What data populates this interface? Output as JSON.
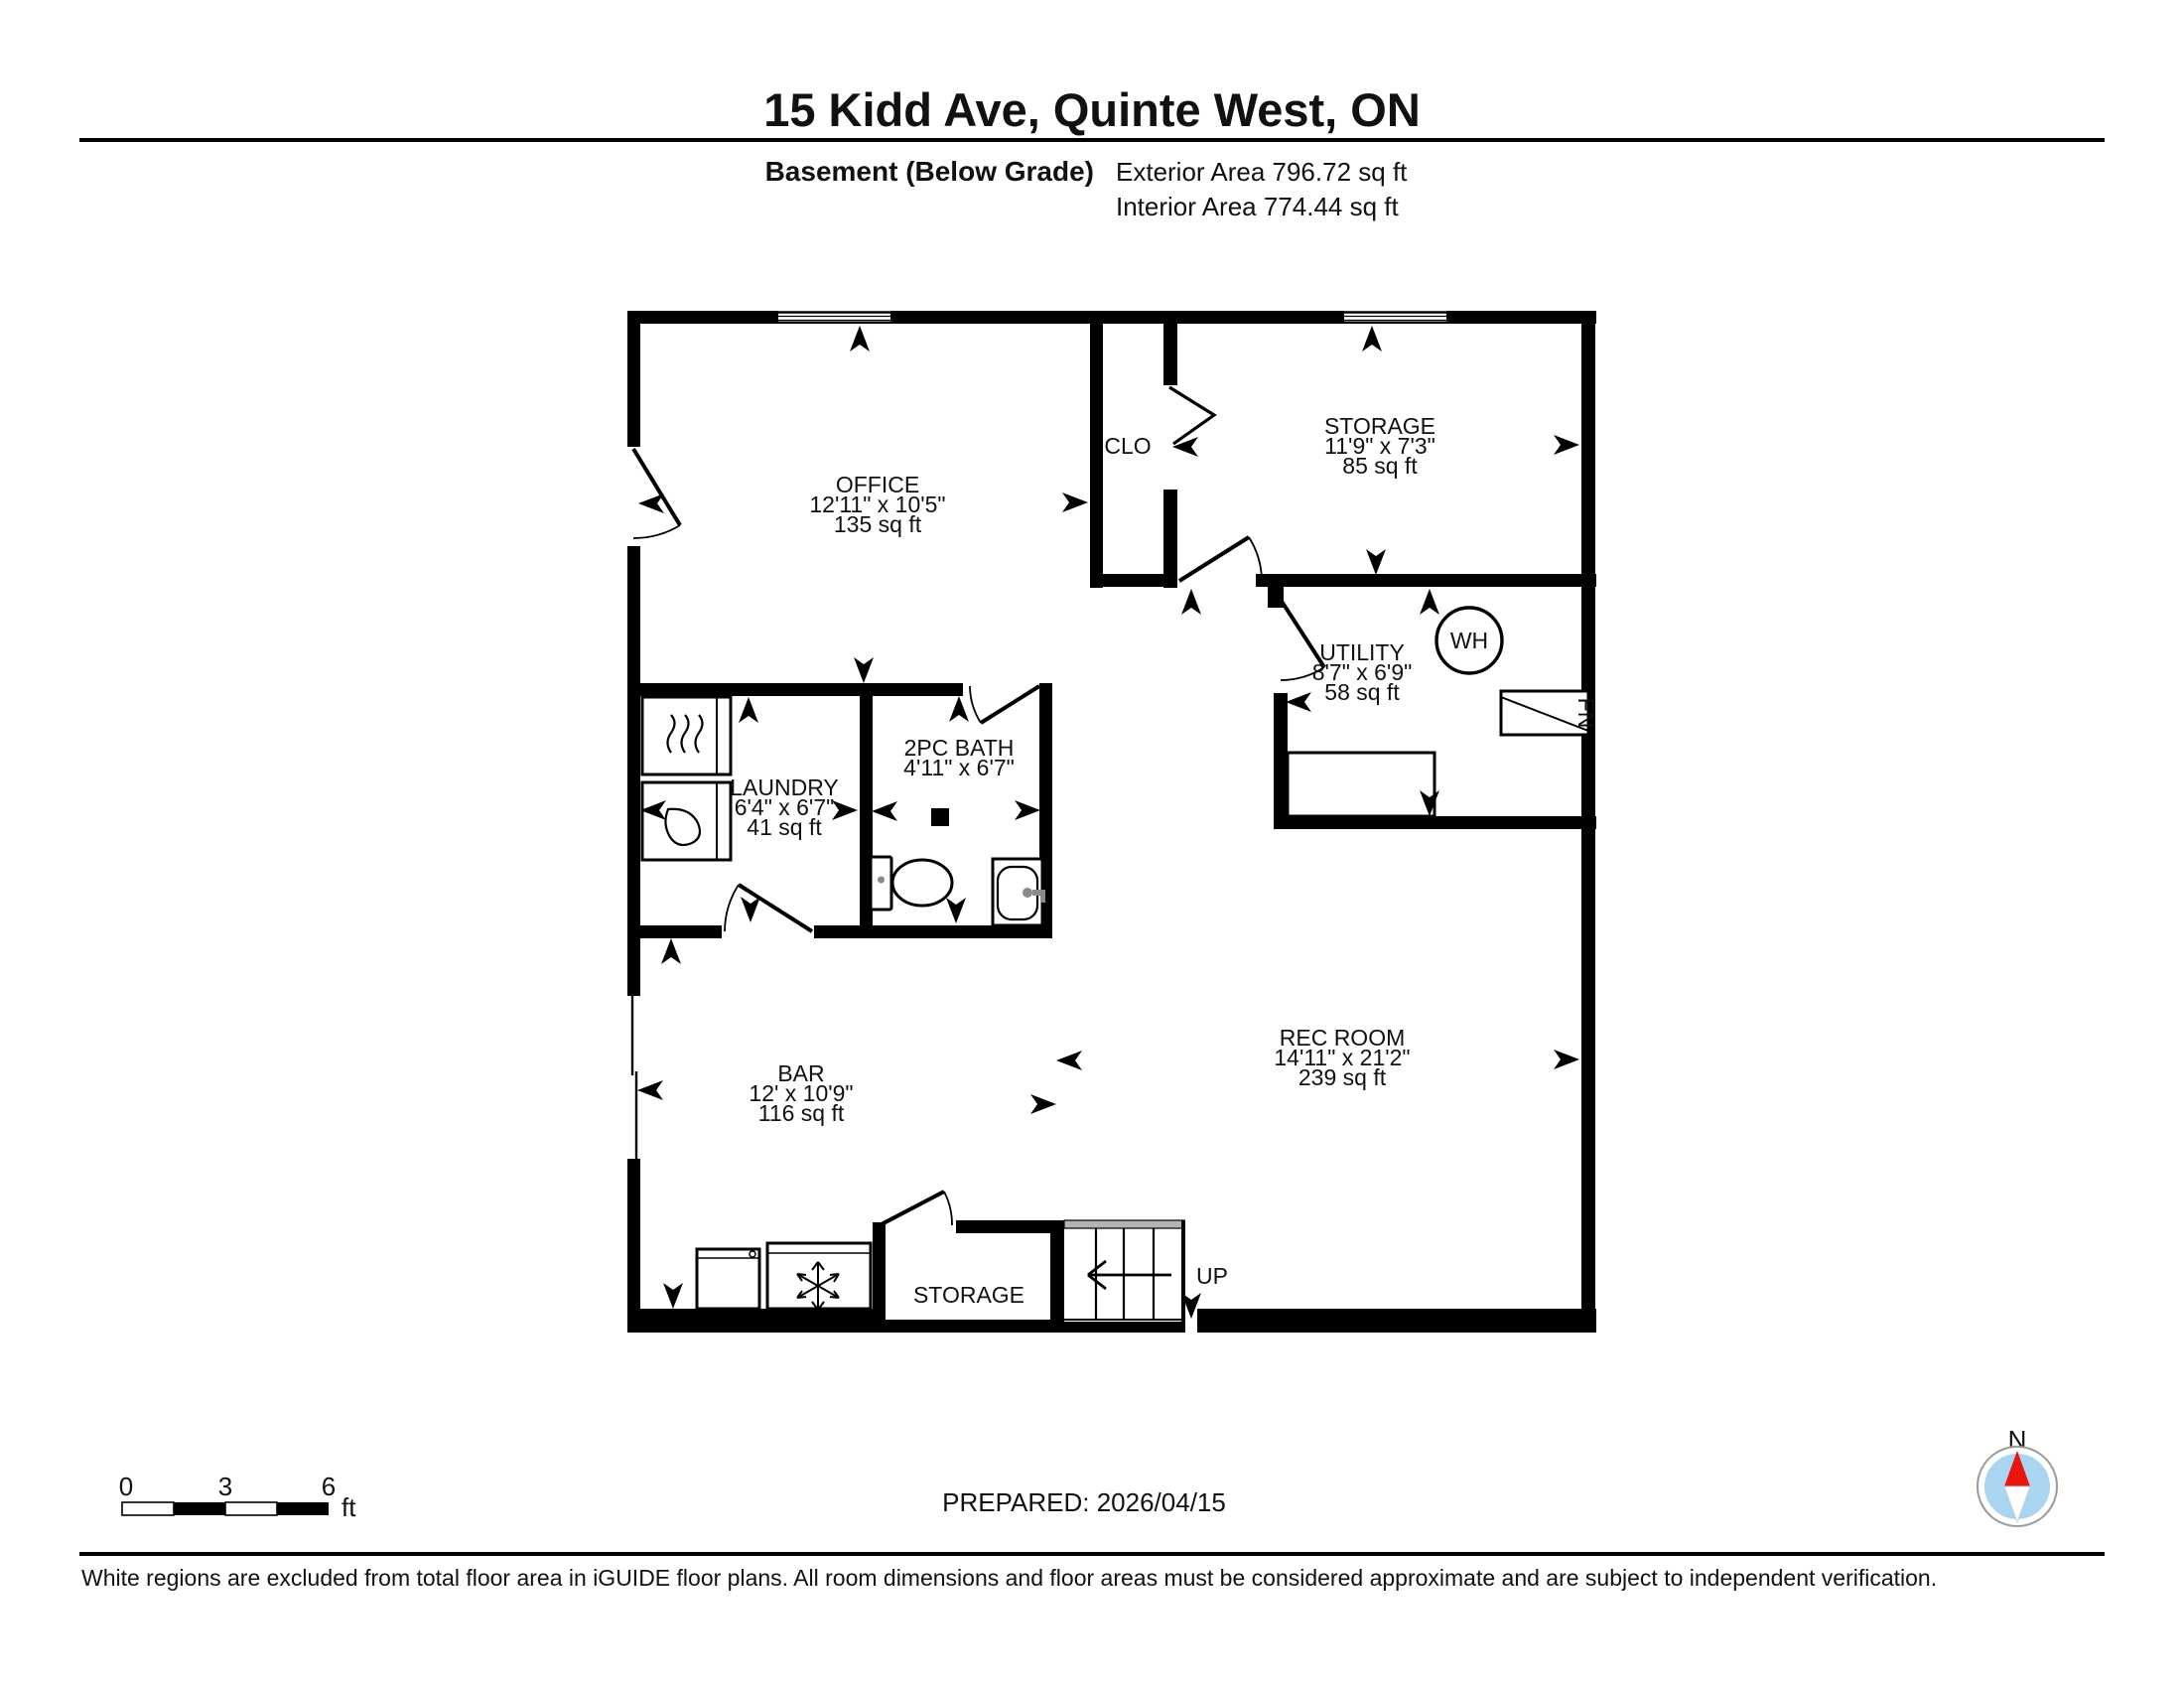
{
  "header": {
    "title": "15 Kidd Ave, Quinte West, ON",
    "floor_label": "Basement (Below Grade)",
    "exterior_area": "Exterior Area 796.72 sq ft",
    "interior_area": "Interior Area 774.44 sq ft"
  },
  "rooms": {
    "office": {
      "name": "OFFICE",
      "dims": "12'11\" x 10'5\"",
      "area": "135 sq ft"
    },
    "clo": {
      "name": "CLO"
    },
    "storage_upper": {
      "name": "STORAGE",
      "dims": "11'9\" x 7'3\"",
      "area": "85 sq ft"
    },
    "utility": {
      "name": "UTILITY",
      "dims": "8'7\" x 6'9\"",
      "area": "58 sq ft"
    },
    "bath": {
      "name": "2PC BATH",
      "dims": "4'11\" x 6'7\""
    },
    "laundry": {
      "name": "LAUNDRY",
      "dims": "6'4\" x 6'7\"",
      "area": "41 sq ft"
    },
    "bar": {
      "name": "BAR",
      "dims": "12' x 10'9\"",
      "area": "116 sq ft"
    },
    "rec_room": {
      "name": "REC ROOM",
      "dims": "14'11\" x 21'2\"",
      "area": "239 sq ft"
    },
    "storage_lower": {
      "name": "STORAGE"
    }
  },
  "fixtures": {
    "water_heater": "WH",
    "furnace": "FN",
    "stairs_direction": "UP"
  },
  "icons": {
    "direction_arrow": "opening-direction-chevron",
    "snowflake": "freezer-snowflake",
    "heat_waves": "dryer-heat-waves",
    "water_drop": "washer-water-drop",
    "compass": "north-compass"
  },
  "scale_bar": {
    "tick0": "0",
    "tick1": "3",
    "tick2": "6",
    "unit": "ft"
  },
  "prepared": "PREPARED: 2026/04/15",
  "compass": {
    "north": "N"
  },
  "footer_note": "White regions are excluded from total floor area in iGUIDE floor plans. All room dimensions and floor areas must be considered approximate and are subject to independent verification.",
  "colors": {
    "wall": "#000000",
    "stair_landing": "#b3b3b3",
    "compass_inner": "#a9d5f1",
    "compass_needle": "#e8160c",
    "fixture_gray": "#8a8a8a"
  }
}
